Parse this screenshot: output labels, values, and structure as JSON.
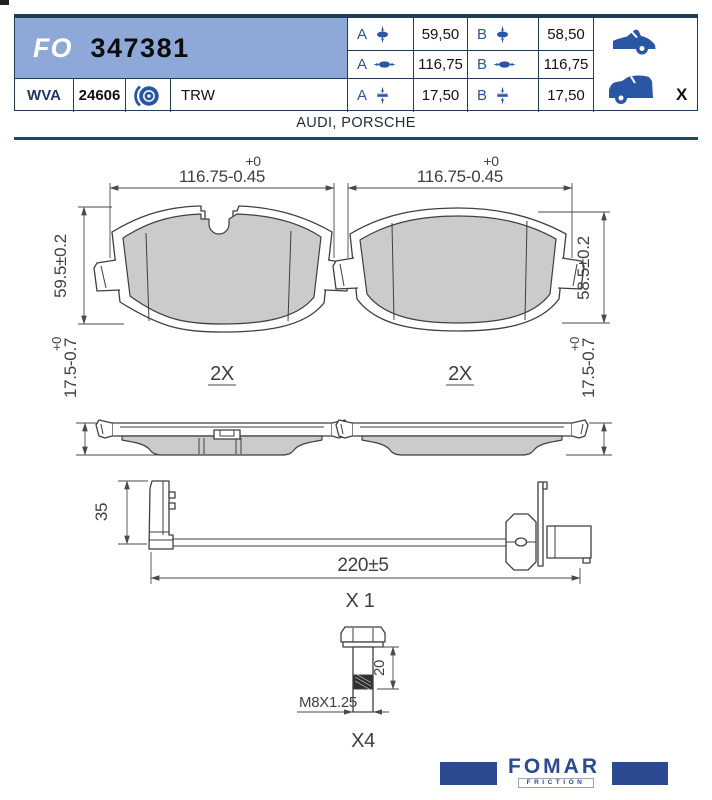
{
  "header": {
    "series_prefix": "FO",
    "part_number": "347381",
    "wva_label": "WVA",
    "wva_number": "24606",
    "brand_reference": "TRW",
    "applications": "AUDI, PORSCHE",
    "rear_axle_marker": "X",
    "dimension_table": {
      "rows": [
        {
          "a_label": "A",
          "a_value": "59,50",
          "b_label": "B",
          "b_value": "58,50"
        },
        {
          "a_label": "A",
          "a_value": "116,75",
          "b_label": "B",
          "b_value": "116,75"
        },
        {
          "a_label": "A",
          "a_value": "17,50",
          "b_label": "B",
          "b_value": "17,50"
        }
      ]
    }
  },
  "drawing": {
    "pad_left": {
      "width_dim": "116.75-0.45",
      "width_tol": "+0",
      "height_dim": "59.5±0.2",
      "thickness_dim": "17.5-0.7",
      "thickness_tol": "+0",
      "quantity": "2X"
    },
    "pad_right": {
      "width_dim": "116.75-0.45",
      "width_tol": "+0",
      "height_dim": "58.5±0.2",
      "thickness_dim": "17.5-0.7",
      "thickness_tol": "+0",
      "quantity": "2X"
    },
    "wear_sensor": {
      "clip_height_dim": "35",
      "length_dim": "220±5",
      "quantity": "X 1"
    },
    "bolt": {
      "shaft_length_dim": "20",
      "thread_spec": "M8X1.25",
      "quantity": "X4"
    }
  },
  "footer": {
    "brand": "FOMAR",
    "sub_brand": "FRICTION"
  },
  "colors": {
    "banner_blue": "#8ea9d8",
    "navy": "#1e3c55",
    "icon_blue": "#2a57a5",
    "logo_blue": "#2b4a91",
    "friction_gray": "#cbcbcb"
  }
}
